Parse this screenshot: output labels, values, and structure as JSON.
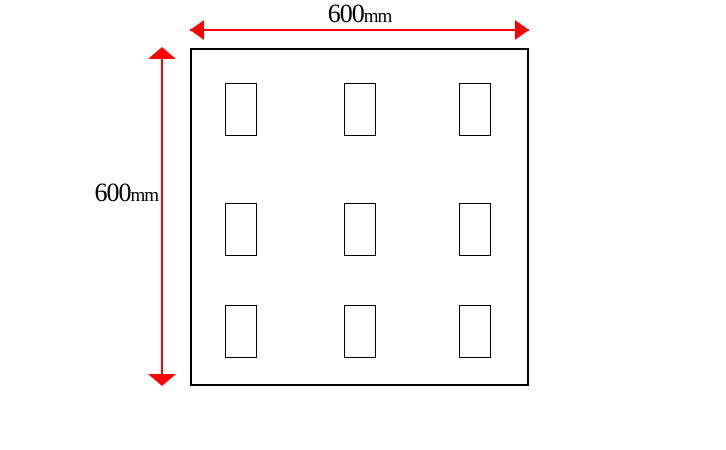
{
  "diagram": {
    "type": "dimensioned-panel-drawing",
    "dimensions": {
      "width": {
        "value": "600",
        "unit": "mm"
      },
      "height": {
        "value": "600",
        "unit": "mm"
      }
    },
    "colors": {
      "dimension_arrow": "#ff0000",
      "outline": "#000000",
      "background": "#ffffff",
      "label_text": "#000000"
    },
    "panel": {
      "grid_rows": 3,
      "grid_cols": 3,
      "cutout_count": 9
    },
    "layout": {
      "square": {
        "left": 190,
        "top": 48,
        "width": 339,
        "height": 338
      },
      "cutout": {
        "width": 32,
        "height": 53
      },
      "col_lefts": [
        225,
        344,
        459
      ],
      "row_tops": [
        83,
        203,
        305
      ]
    }
  }
}
